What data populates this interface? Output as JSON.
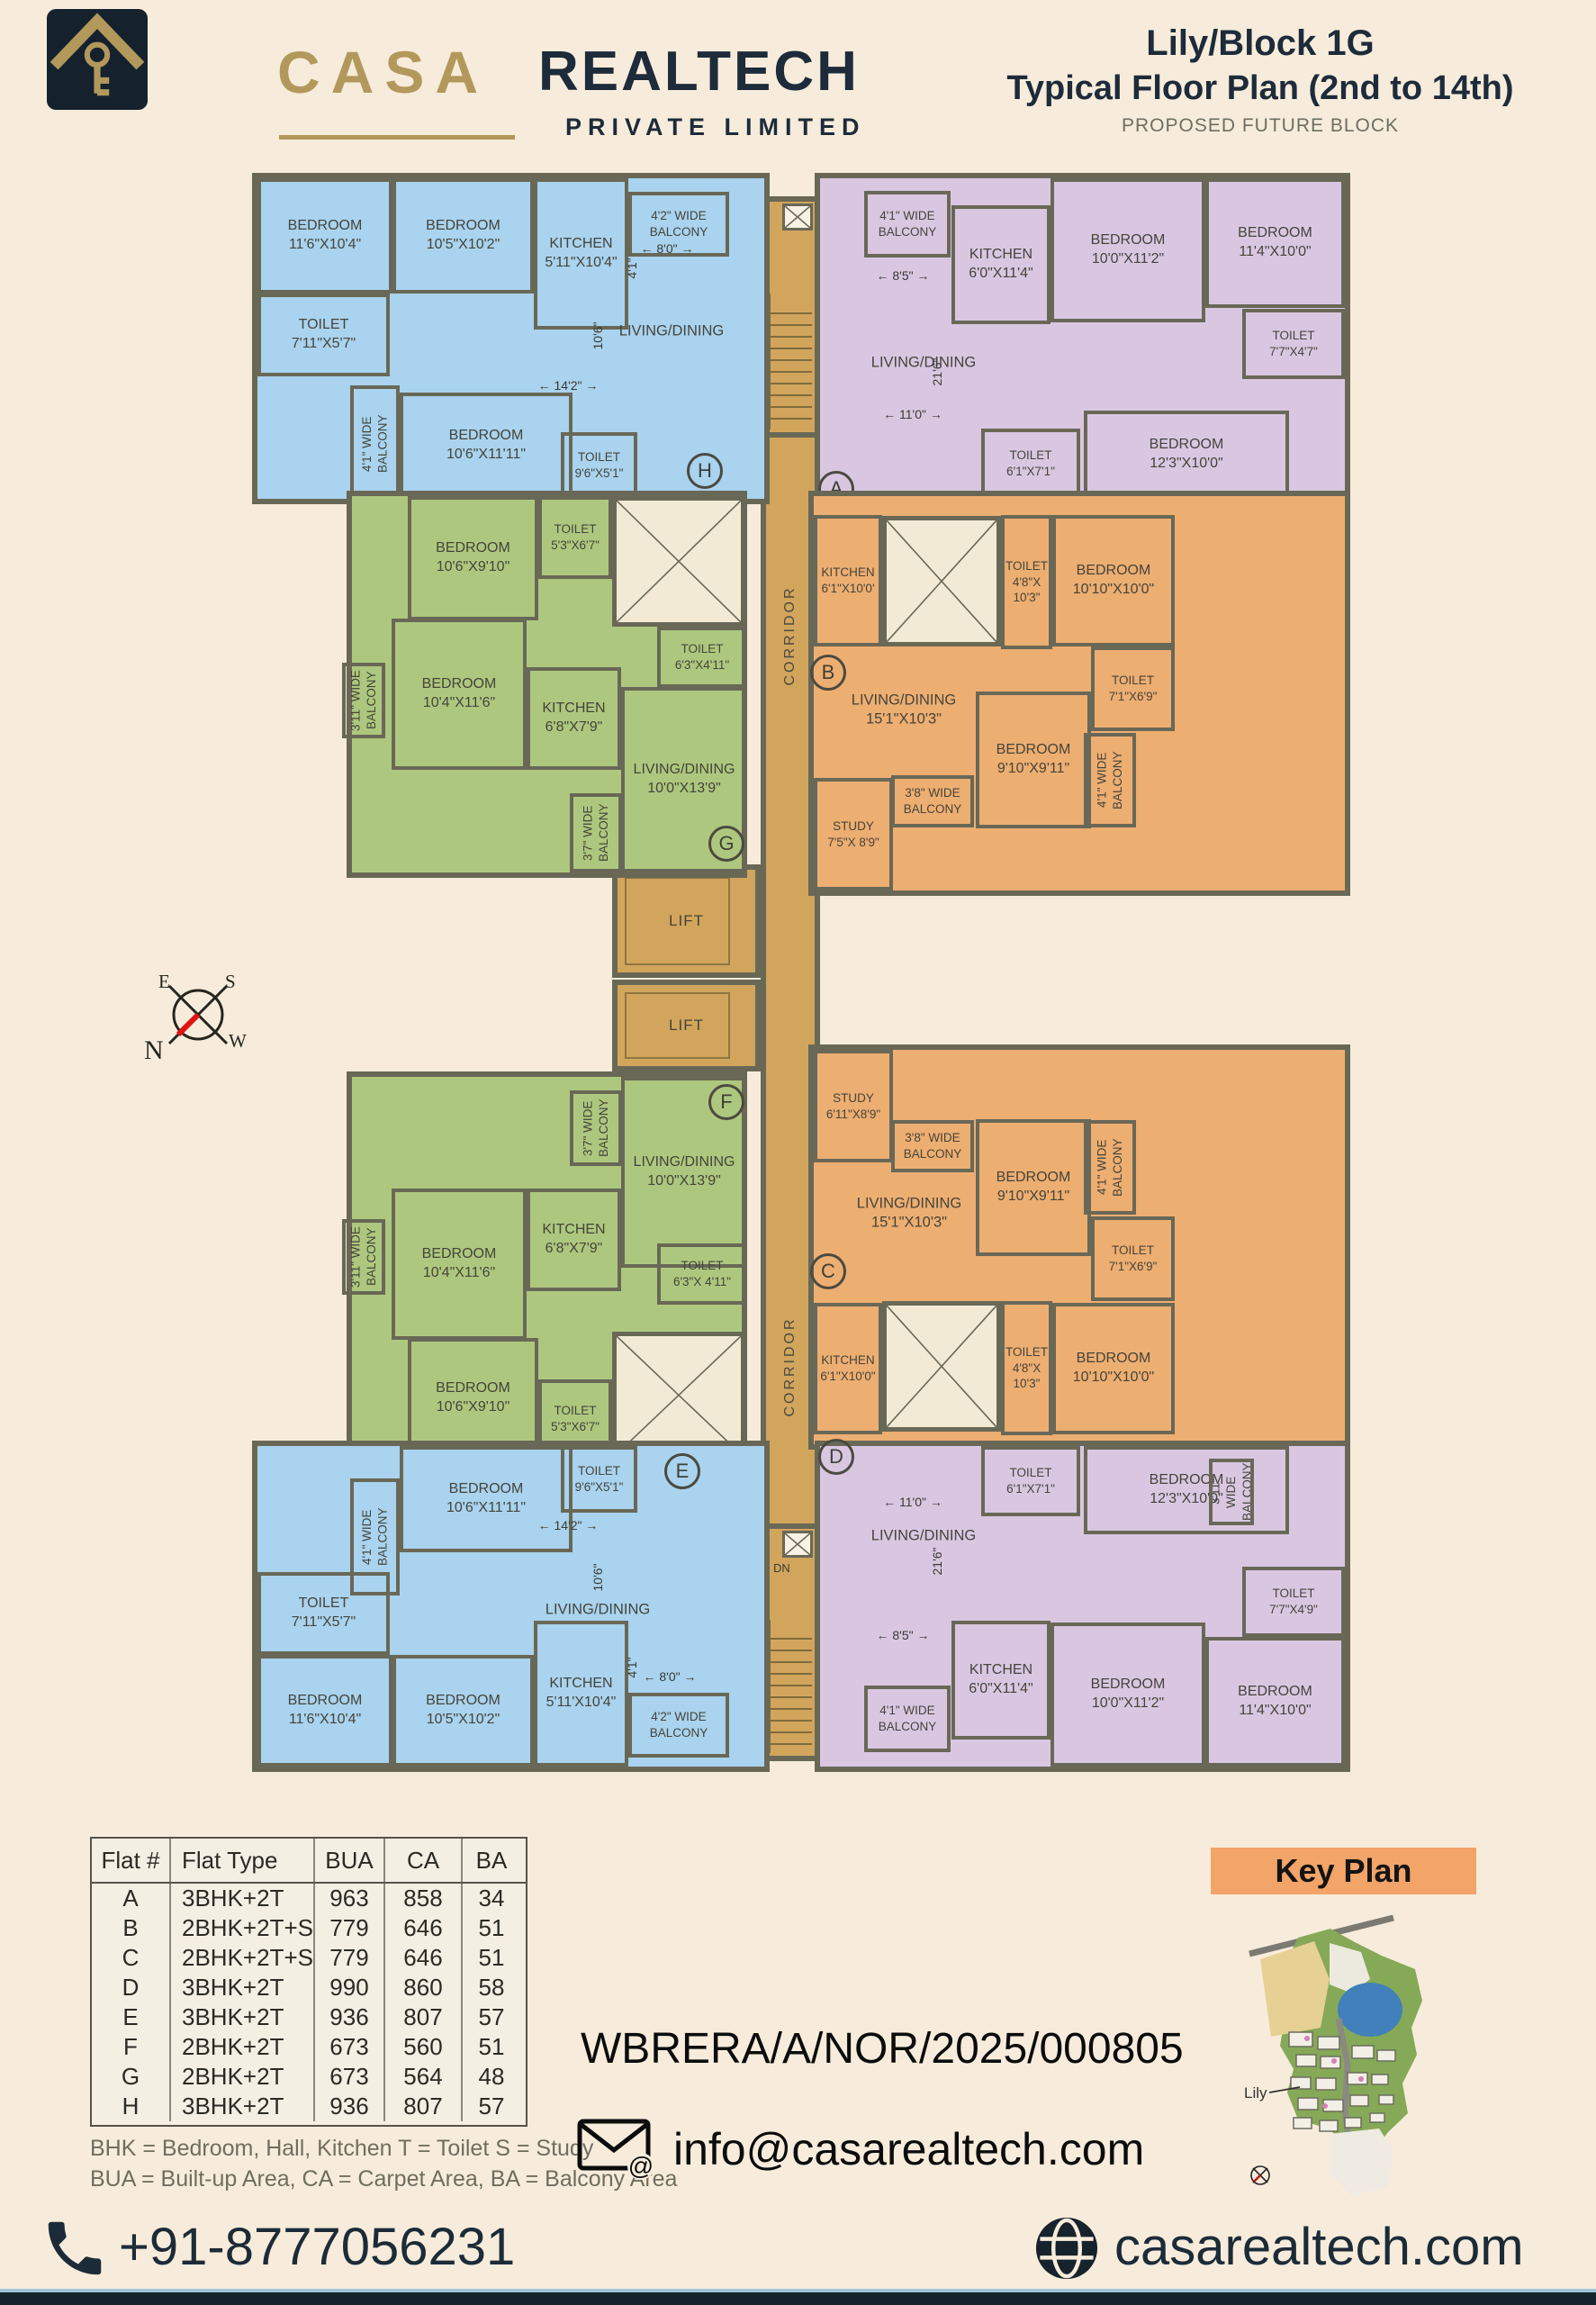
{
  "header": {
    "brand": {
      "casa": "CASA",
      "realtech": "REALTECH",
      "subtitle": "PRIVATE LIMITED"
    },
    "title1": "Lily/Block 1G",
    "title2": "Typical  Floor Plan (2nd to 14th)",
    "title3": "PROPOSED FUTURE BLOCK"
  },
  "core": {
    "corridor": "CORRIDOR",
    "lift": "LIFT",
    "up": "UP",
    "dn": "DN"
  },
  "compass": {
    "e": "E",
    "s": "S",
    "n": "N",
    "w": "W"
  },
  "units": {
    "H": {
      "label": "H",
      "rooms": [
        "BEDROOM\n11'6\"X10'4\"",
        "BEDROOM\n10'5\"X10'2\"",
        "KITCHEN\n5'11\"X10'4\"",
        "4'2\" WIDE\nBALCONY",
        "TOILET\n7'11\"X5'7\"",
        "4'1\" WIDE\nBALCONY",
        "BEDROOM\n10'6\"X11'11\"",
        "TOILET\n9'6\"X5'1\"",
        "LIVING/DINING"
      ],
      "dims": [
        "8'0\"",
        "4'1\"",
        "10'6\"",
        "14'2\""
      ]
    },
    "A": {
      "label": "A",
      "rooms": [
        "4'1\" WIDE\nBALCONY",
        "KITCHEN\n6'0\"X11'4\"",
        "BEDROOM\n10'0\"X11'2\"",
        "BEDROOM\n11'4\"X10'0\"",
        "TOILET\n7'7\"X4'7\"",
        "TOILET\n6'1\"X7'1\"",
        "BEDROOM\n12'3\"X10'0\"",
        "LIVING/DINING"
      ],
      "dims": [
        "8'5\"",
        "21'6\"",
        "11'0\""
      ]
    },
    "G": {
      "label": "G",
      "rooms": [
        "BEDROOM\n10'6\"X9'10\"",
        "TOILET\n5'3\"X6'7\"",
        "TOILET\n6'3\"X4'11\"",
        "BEDROOM\n10'4\"X11'6\"",
        "KITCHEN\n6'8\"X7'9\"",
        "LIVING/DINING\n10'0\"X13'9\"",
        "3'11\" WIDE\nBALCONY",
        "3'7\" WIDE\nBALCONY"
      ]
    },
    "B": {
      "label": "B",
      "rooms": [
        "KITCHEN\n6'1\"X10'0'",
        "TOILET\n4'8\"X\n10'3\"",
        "BEDROOM\n10'10\"X10'0\"",
        "TOILET\n7'1\"X6'9\"",
        "LIVING/DINING\n15'1\"X10'3\"",
        "BEDROOM\n9'10\"X9'11\"",
        "3'8\" WIDE\nBALCONY",
        "STUDY\n7'5\"X 8'9\"",
        "4'1\" WIDE\nBALCONY"
      ]
    },
    "F": {
      "label": "F",
      "rooms": [
        "3'7\" WIDE\nBALCONY",
        "LIVING/DINING\n10'0\"X13'9\"",
        "KITCHEN\n6'8\"X7'9\"",
        "BEDROOM\n10'4\"X11'6\"",
        "3'11\" WIDE\nBALCONY",
        "TOILET\n6'3\"X 4'11\"",
        "BEDROOM\n10'6\"X9'10\"",
        "TOILET\n5'3\"X6'7\""
      ]
    },
    "C": {
      "label": "C",
      "rooms": [
        "STUDY\n6'11\"X8'9\"",
        "3'8\" WIDE\nBALCONY",
        "BEDROOM\n9'10\"X9'11\"",
        "4'1\" WIDE\nBALCONY",
        "TOILET\n7'1\"X6'9\"",
        "LIVING/DINING\n15'1\"X10'3\"",
        "KITCHEN\n6'1\"X10'0\"",
        "TOILET\n4'8\"X\n10'3\"",
        "BEDROOM\n10'10\"X10'0\""
      ]
    },
    "E": {
      "label": "E",
      "rooms": [
        "TOILET\n9'6\"X5'1\"",
        "BEDROOM\n10'6\"X11'11\"",
        "4'1\" WIDE\nBALCONY",
        "LIVING/DINING",
        "TOILET\n7'11\"X5'7\"",
        "BEDROOM\n11'6\"X10'4\"",
        "BEDROOM\n10'5\"X10'2\"",
        "KITCHEN\n5'11'X10'4\"",
        "4'2\" WIDE\nBALCONY"
      ],
      "dims": [
        "14'2\"",
        "10'6\"",
        "4'1\"",
        "8'0\""
      ]
    },
    "D": {
      "label": "D",
      "rooms": [
        "TOILET\n6'1\"X7'1\"",
        "BEDROOM\n12'3\"X10'0\"",
        "3'11\" WIDE\nBALCONY",
        "LIVING/DINING",
        "TOILET\n7'7\"X4'9\"",
        "KITCHEN\n6'0\"X11'4\"",
        "BEDROOM\n10'0\"X11'2\"",
        "BEDROOM\n11'4\"X10'0\"",
        "4'1\" WIDE\nBALCONY"
      ],
      "dims": [
        "11'0\"",
        "21'6\"",
        "8'5\""
      ]
    }
  },
  "table": {
    "headers": [
      "Flat #",
      "Flat Type",
      "BUA",
      "CA",
      "BA"
    ],
    "rows": [
      [
        "A",
        "3BHK+2T",
        "963",
        "858",
        "34"
      ],
      [
        "B",
        "2BHK+2T+S",
        "779",
        "646",
        "51"
      ],
      [
        "C",
        "2BHK+2T+S",
        "779",
        "646",
        "51"
      ],
      [
        "D",
        "3BHK+2T",
        "990",
        "860",
        "58"
      ],
      [
        "E",
        "3BHK+2T",
        "936",
        "807",
        "57"
      ],
      [
        "F",
        "2BHK+2T",
        "673",
        "560",
        "51"
      ],
      [
        "G",
        "2BHK+2T",
        "673",
        "564",
        "48"
      ],
      [
        "H",
        "3BHK+2T",
        "936",
        "807",
        "57"
      ]
    ]
  },
  "notes": [
    "BHK = Bedroom, Hall, Kitchen  T = Toilet  S = Study",
    "BUA = Built-up Area, CA = Carpet Area, BA = Balcony Area"
  ],
  "contact": {
    "rera": "WBRERA/A/NOR/2025/000805",
    "email": "info@casarealtech.com"
  },
  "keyplan": {
    "title": "Key Plan",
    "lily": "Lily"
  },
  "footer": {
    "phone": "+91-8777056231",
    "website": "casarealtech.com"
  },
  "colors": {
    "blue": "#a9d3ee",
    "purple": "#d9c7e2",
    "green": "#adc87e",
    "orange": "#edae71",
    "corridor": "#d2a55c",
    "wall": "#696857",
    "navy": "#16222c",
    "gold": "#b3985c",
    "banner": "#f2a469"
  }
}
